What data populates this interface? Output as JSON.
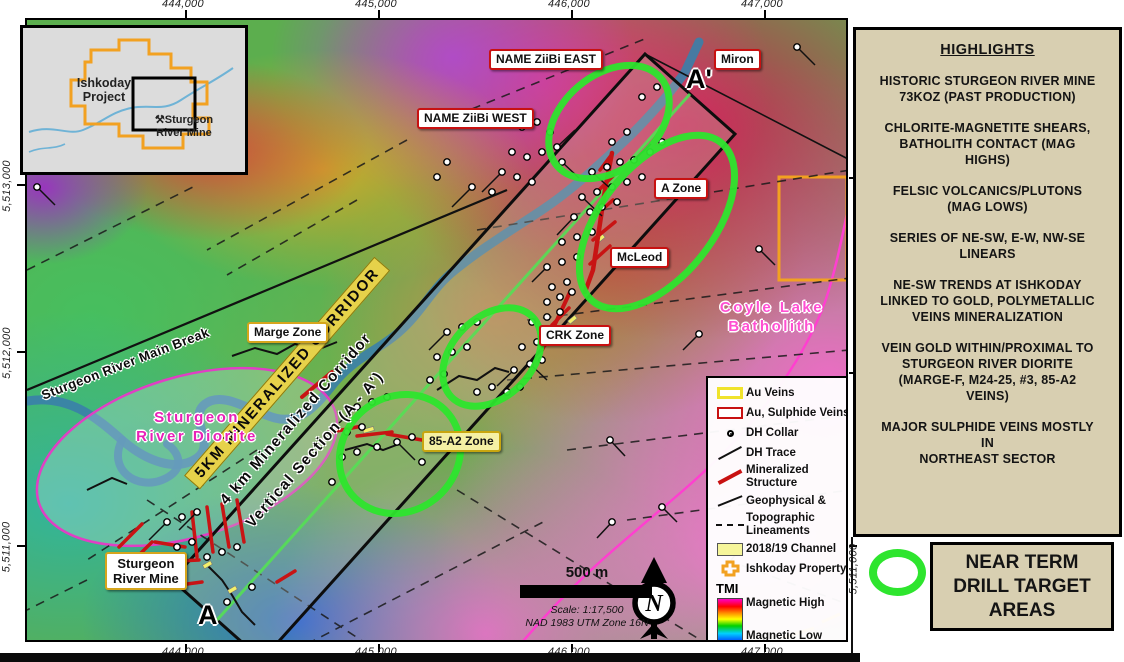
{
  "axes": {
    "top": [
      "444,000",
      "445,000",
      "446,000",
      "447,000"
    ],
    "bottom": [
      "444,000",
      "445,000",
      "446,000",
      "447,000"
    ],
    "left": [
      "5,513,000",
      "5,512,000",
      "5,511,000"
    ],
    "right": [
      "5,511,000"
    ]
  },
  "inset": {
    "project_label": "Ishkoday Project",
    "mine_label": "Sturgeon River Mine",
    "mine_icon": "⚒"
  },
  "map": {
    "labels": {
      "ziibi_east": "NAME ZiiBi EAST",
      "ziibi_west": "NAME ZiiBi WEST",
      "miron": "Miron",
      "a_prime": "A'",
      "a": "A",
      "a_zone": "A Zone",
      "mcleod": "McLeod",
      "crk_zone": "CRK Zone",
      "marge_zone": "Marge Zone",
      "zone_85a2": "85-A2 Zone",
      "mine": "Sturgeon\nRiver Mine",
      "main_break": "Sturgeon River Main Break",
      "diorite": "Sturgeon\nRiver Diorite",
      "batholith": "Coyle Lake\nBatholith",
      "corridor_5km": "5KM MINERALIZED CORRIDOR",
      "corridor_4km": "4 km Mineralized Corridor",
      "vertical_section": "Vertical Section (A - A')"
    }
  },
  "legend": {
    "au_veins": "Au Veins",
    "au_sulphide": "Au, Sulphide Veins",
    "dh_collar": "DH Collar",
    "dh_trace": "DH Trace",
    "mineralized": "Mineralized Structure",
    "geophysical": "Geophysical &",
    "topographic": "Topographic Lineaments",
    "channel": "2018/19 Channel",
    "property": "Ishkoday Property",
    "tmi": "TMI",
    "mag_high": "Magnetic High",
    "mag_low": "Magnetic Low"
  },
  "scalebar": {
    "distance": "500 m",
    "scale": "Scale: 1:17,500",
    "datum": "NAD 1983 UTM Zone 16N",
    "north": "N"
  },
  "sidebar": {
    "title": "HIGHLIGHTS",
    "items": [
      "HISTORIC STURGEON RIVER MINE\n73KOZ (PAST PRODUCTION)",
      "CHLORITE-MAGNETITE SHEARS,\nBATHOLITH CONTACT (MAG\nHIGHS)",
      "FELSIC VOLCANICS/PLUTONS\n(MAG LOWS)",
      "SERIES OF NE-SW, E-W, NW-SE\nLINEARS",
      "NE-SW TRENDS AT ISHKODAY\nLINKED TO GOLD, POLYMETALLIC\nVEINS MINERALIZATION",
      "VEIN GOLD WITHIN/PROXIMAL TO\nSTURGEON RIVER DIORITE\n(MARGE-F, M24-25, #3, 85-A2\nVEINS)",
      "MAJOR SULPHIDE VEINS MOSTLY\nIN\nNORTHEAST SECTOR"
    ]
  },
  "target_box": {
    "label": "NEAR TERM\nDRILL TARGET\nAREAS"
  },
  "colors": {
    "lime": "#2ee52e",
    "panel_tan": "#d8cfb1",
    "label_red": "#c81111",
    "gold_border": "#d6a51c",
    "magenta_outline": "#e03fc4",
    "pink_text": "#ff4fd2",
    "property_orange": "#f2a121",
    "river_blue": "#3a80aa"
  }
}
